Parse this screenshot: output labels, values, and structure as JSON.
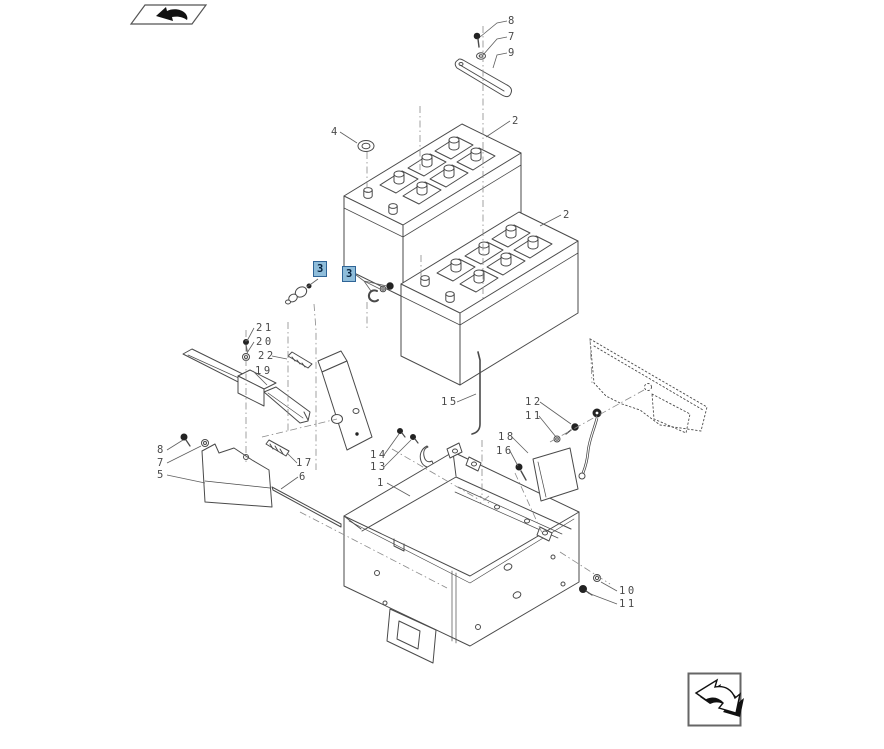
{
  "diagram": {
    "kind": "exploded-parts-diagram",
    "line_color": "#4a4a4a",
    "phantom_line_color": "#8a8a8a",
    "background": "#ffffff"
  },
  "highlight": {
    "fill": "#8fbdda",
    "border": "#2f6496",
    "text_color": "#06223f"
  },
  "nav": {
    "prev_icon": "hand-arrow-left-icon",
    "next_icon": "arrow-down-right-icon"
  },
  "callouts": [
    {
      "label": "8",
      "x": 508,
      "y": 15,
      "highlighted": false
    },
    {
      "label": "7",
      "x": 508,
      "y": 31,
      "highlighted": false
    },
    {
      "label": "9",
      "x": 508,
      "y": 47,
      "highlighted": false
    },
    {
      "label": "4",
      "x": 331,
      "y": 126,
      "highlighted": false
    },
    {
      "label": "2",
      "x": 512,
      "y": 115,
      "highlighted": false
    },
    {
      "label": "2",
      "x": 563,
      "y": 209,
      "highlighted": false
    },
    {
      "label": "3",
      "x": 313,
      "y": 261,
      "highlighted": true
    },
    {
      "label": "3",
      "x": 342,
      "y": 266,
      "highlighted": true
    },
    {
      "label": "21",
      "x": 256,
      "y": 322,
      "highlighted": false
    },
    {
      "label": "20",
      "x": 256,
      "y": 336,
      "highlighted": false
    },
    {
      "label": "22",
      "x": 258,
      "y": 350,
      "highlighted": false
    },
    {
      "label": "19",
      "x": 255,
      "y": 365,
      "highlighted": false
    },
    {
      "label": "15",
      "x": 441,
      "y": 396,
      "highlighted": false
    },
    {
      "label": "12",
      "x": 525,
      "y": 396,
      "highlighted": false
    },
    {
      "label": "11",
      "x": 525,
      "y": 410,
      "highlighted": false
    },
    {
      "label": "18",
      "x": 498,
      "y": 431,
      "highlighted": false
    },
    {
      "label": "16",
      "x": 496,
      "y": 445,
      "highlighted": false
    },
    {
      "label": "14",
      "x": 370,
      "y": 449,
      "highlighted": false
    },
    {
      "label": "13",
      "x": 370,
      "y": 461,
      "highlighted": false
    },
    {
      "label": "1",
      "x": 377,
      "y": 477,
      "highlighted": false
    },
    {
      "label": "8",
      "x": 157,
      "y": 444,
      "highlighted": false
    },
    {
      "label": "7",
      "x": 157,
      "y": 457,
      "highlighted": false
    },
    {
      "label": "5",
      "x": 157,
      "y": 469,
      "highlighted": false
    },
    {
      "label": "17",
      "x": 296,
      "y": 457,
      "highlighted": false
    },
    {
      "label": "6",
      "x": 299,
      "y": 471,
      "highlighted": false
    },
    {
      "label": "10",
      "x": 619,
      "y": 585,
      "highlighted": false
    },
    {
      "label": "11",
      "x": 619,
      "y": 598,
      "highlighted": false
    }
  ]
}
